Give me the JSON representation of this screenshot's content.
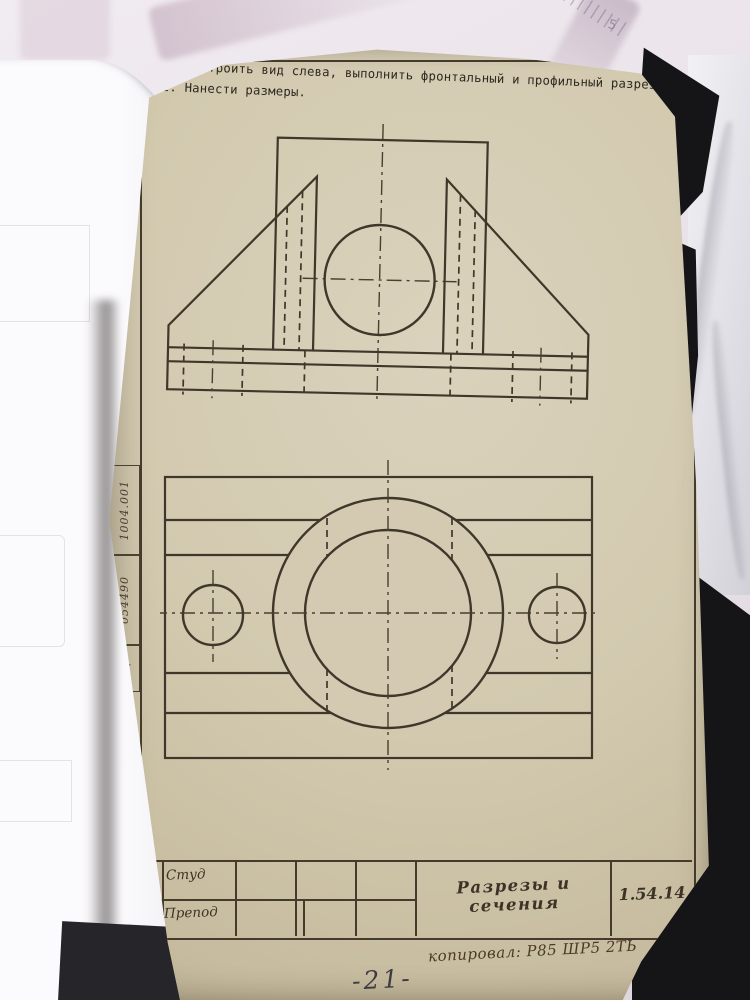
{
  "instructions": {
    "line1": "1. Построить вид слева, выполнить фронтальный и профильный разрезы.",
    "line2": "2. Нанести размеры."
  },
  "title_block": {
    "row1_label": "Студ",
    "row2_label": "Препод",
    "title": "Разрезы и сечения",
    "code": "1.54.14",
    "copied_note": "копировал: Р85  ШР5 2ТЬ"
  },
  "margin": {
    "doc_number": "1004.001",
    "inventory_number": "054490",
    "mark": "и/р"
  },
  "page_number": "-21-",
  "background": {
    "ruler_label": "5"
  },
  "colors": {
    "page_beige": "#d2c9af",
    "ink": "#3f372a",
    "folder_black": "#151518",
    "desk_pink": "#e7dfe6",
    "white_pages": "#f5f4f6"
  }
}
